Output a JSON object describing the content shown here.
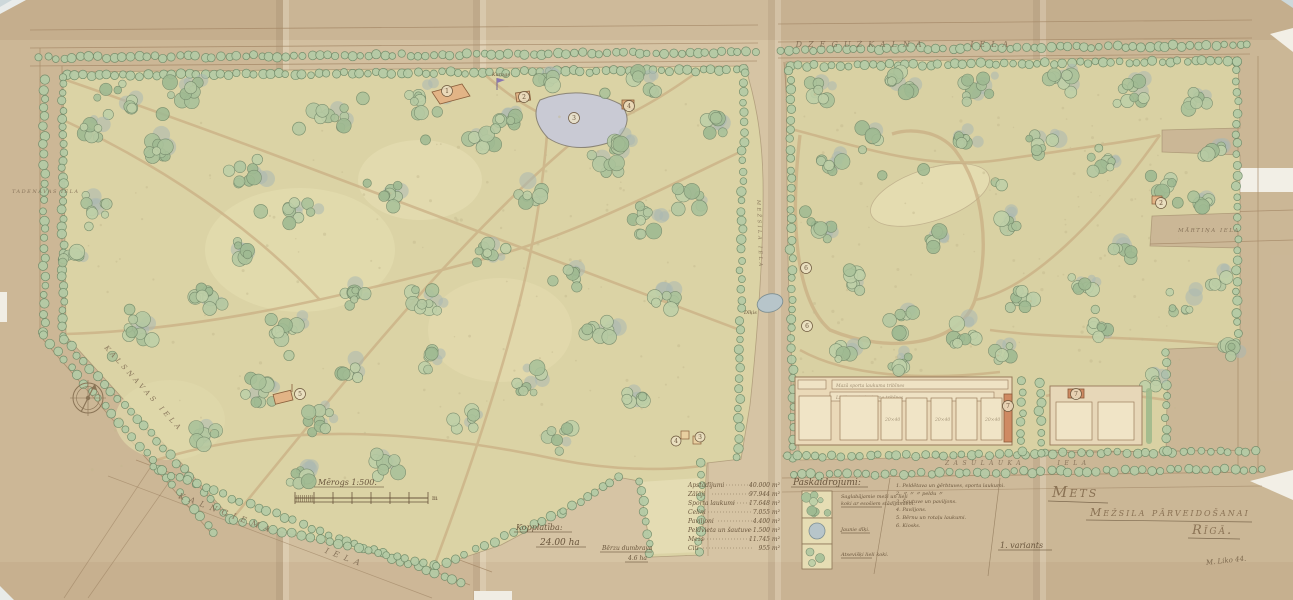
{
  "title_block": {
    "line1": "Mets",
    "line2": "Mežsila pārveidošanai",
    "line3": "Rīgā.",
    "variant": "1. variants",
    "signature": "M. Liko 44."
  },
  "streets": {
    "top": "DZEGUŽKALNA IELA",
    "left": "TADENAVAS IELA",
    "left_diagonal": "KALSNAVAS IELA",
    "bottom_left": "KALNCIEMA IELA",
    "bottom_center": "ZASULAUKA IELA",
    "right": "MĀRTIŅA IELA",
    "central": "MEŽSILA IELA"
  },
  "scale": {
    "label": "Mērogs 1:500.",
    "unit": "m"
  },
  "totals": {
    "label": "Kopplatība:",
    "value": "24.00 ha",
    "sub_label": "Bērzu dumbrava",
    "sub_value": "4.6 ha"
  },
  "areas": {
    "rows": [
      {
        "label": "Apstādījumi",
        "value": "40.000 m²"
      },
      {
        "label": "Zālāji",
        "value": "97.944 m²"
      },
      {
        "label": "Sporta laukumi",
        "value": "17.648 m²"
      },
      {
        "label": "Celiņi",
        "value": "7.055 m²"
      },
      {
        "label": "Paviljoni",
        "value": "4.400 m²"
      },
      {
        "label": "Peldvieta un šautuve",
        "value": "1.500 m²"
      },
      {
        "label": "Mežs",
        "value": "11.745 m²"
      },
      {
        "label": "Citi",
        "value": "955 m²"
      }
    ]
  },
  "legend": {
    "header": "Paskaidrojumi:",
    "swatches": [
      {
        "line1": "Saglabājamie meži un lieli",
        "line2": "koki ar esošiem stādījumiem."
      },
      {
        "line1": "Jaunie dīķi.",
        "line2": ""
      },
      {
        "line1": "Atsevišķi lieli koki.",
        "line2": ""
      }
    ],
    "numbered": [
      "1. Peldētava un ģērbtuves, sporta laukumi.",
      "2.    〃       〃       〃    peldu    〃",
      "3. Šautuve un paviljons.",
      "4. Paviljons.",
      "5. Bērnu un rotaļu laukumi.",
      "6. Kiosks."
    ]
  },
  "map_labels": {
    "flag": "Karogs",
    "pond": "Dīķis"
  },
  "sports": {
    "band1": "Mazā sporta laukuma tribīnes",
    "band2": "Lielā sporta laukuma tribīnes",
    "court_dim": "20×40"
  },
  "markers": [
    "1",
    "2",
    "3",
    "4",
    "5",
    "3",
    "4",
    "6",
    "6",
    "7",
    "7",
    "2"
  ],
  "colors": {
    "paper": "#d2bf9f",
    "park": "#dbd3a5",
    "tree_green": "#b5c9a2",
    "shadow_green": "#a9b8b2",
    "water": "#b7c5ca",
    "building": "#cf8a63",
    "ink": "#6a563d"
  }
}
